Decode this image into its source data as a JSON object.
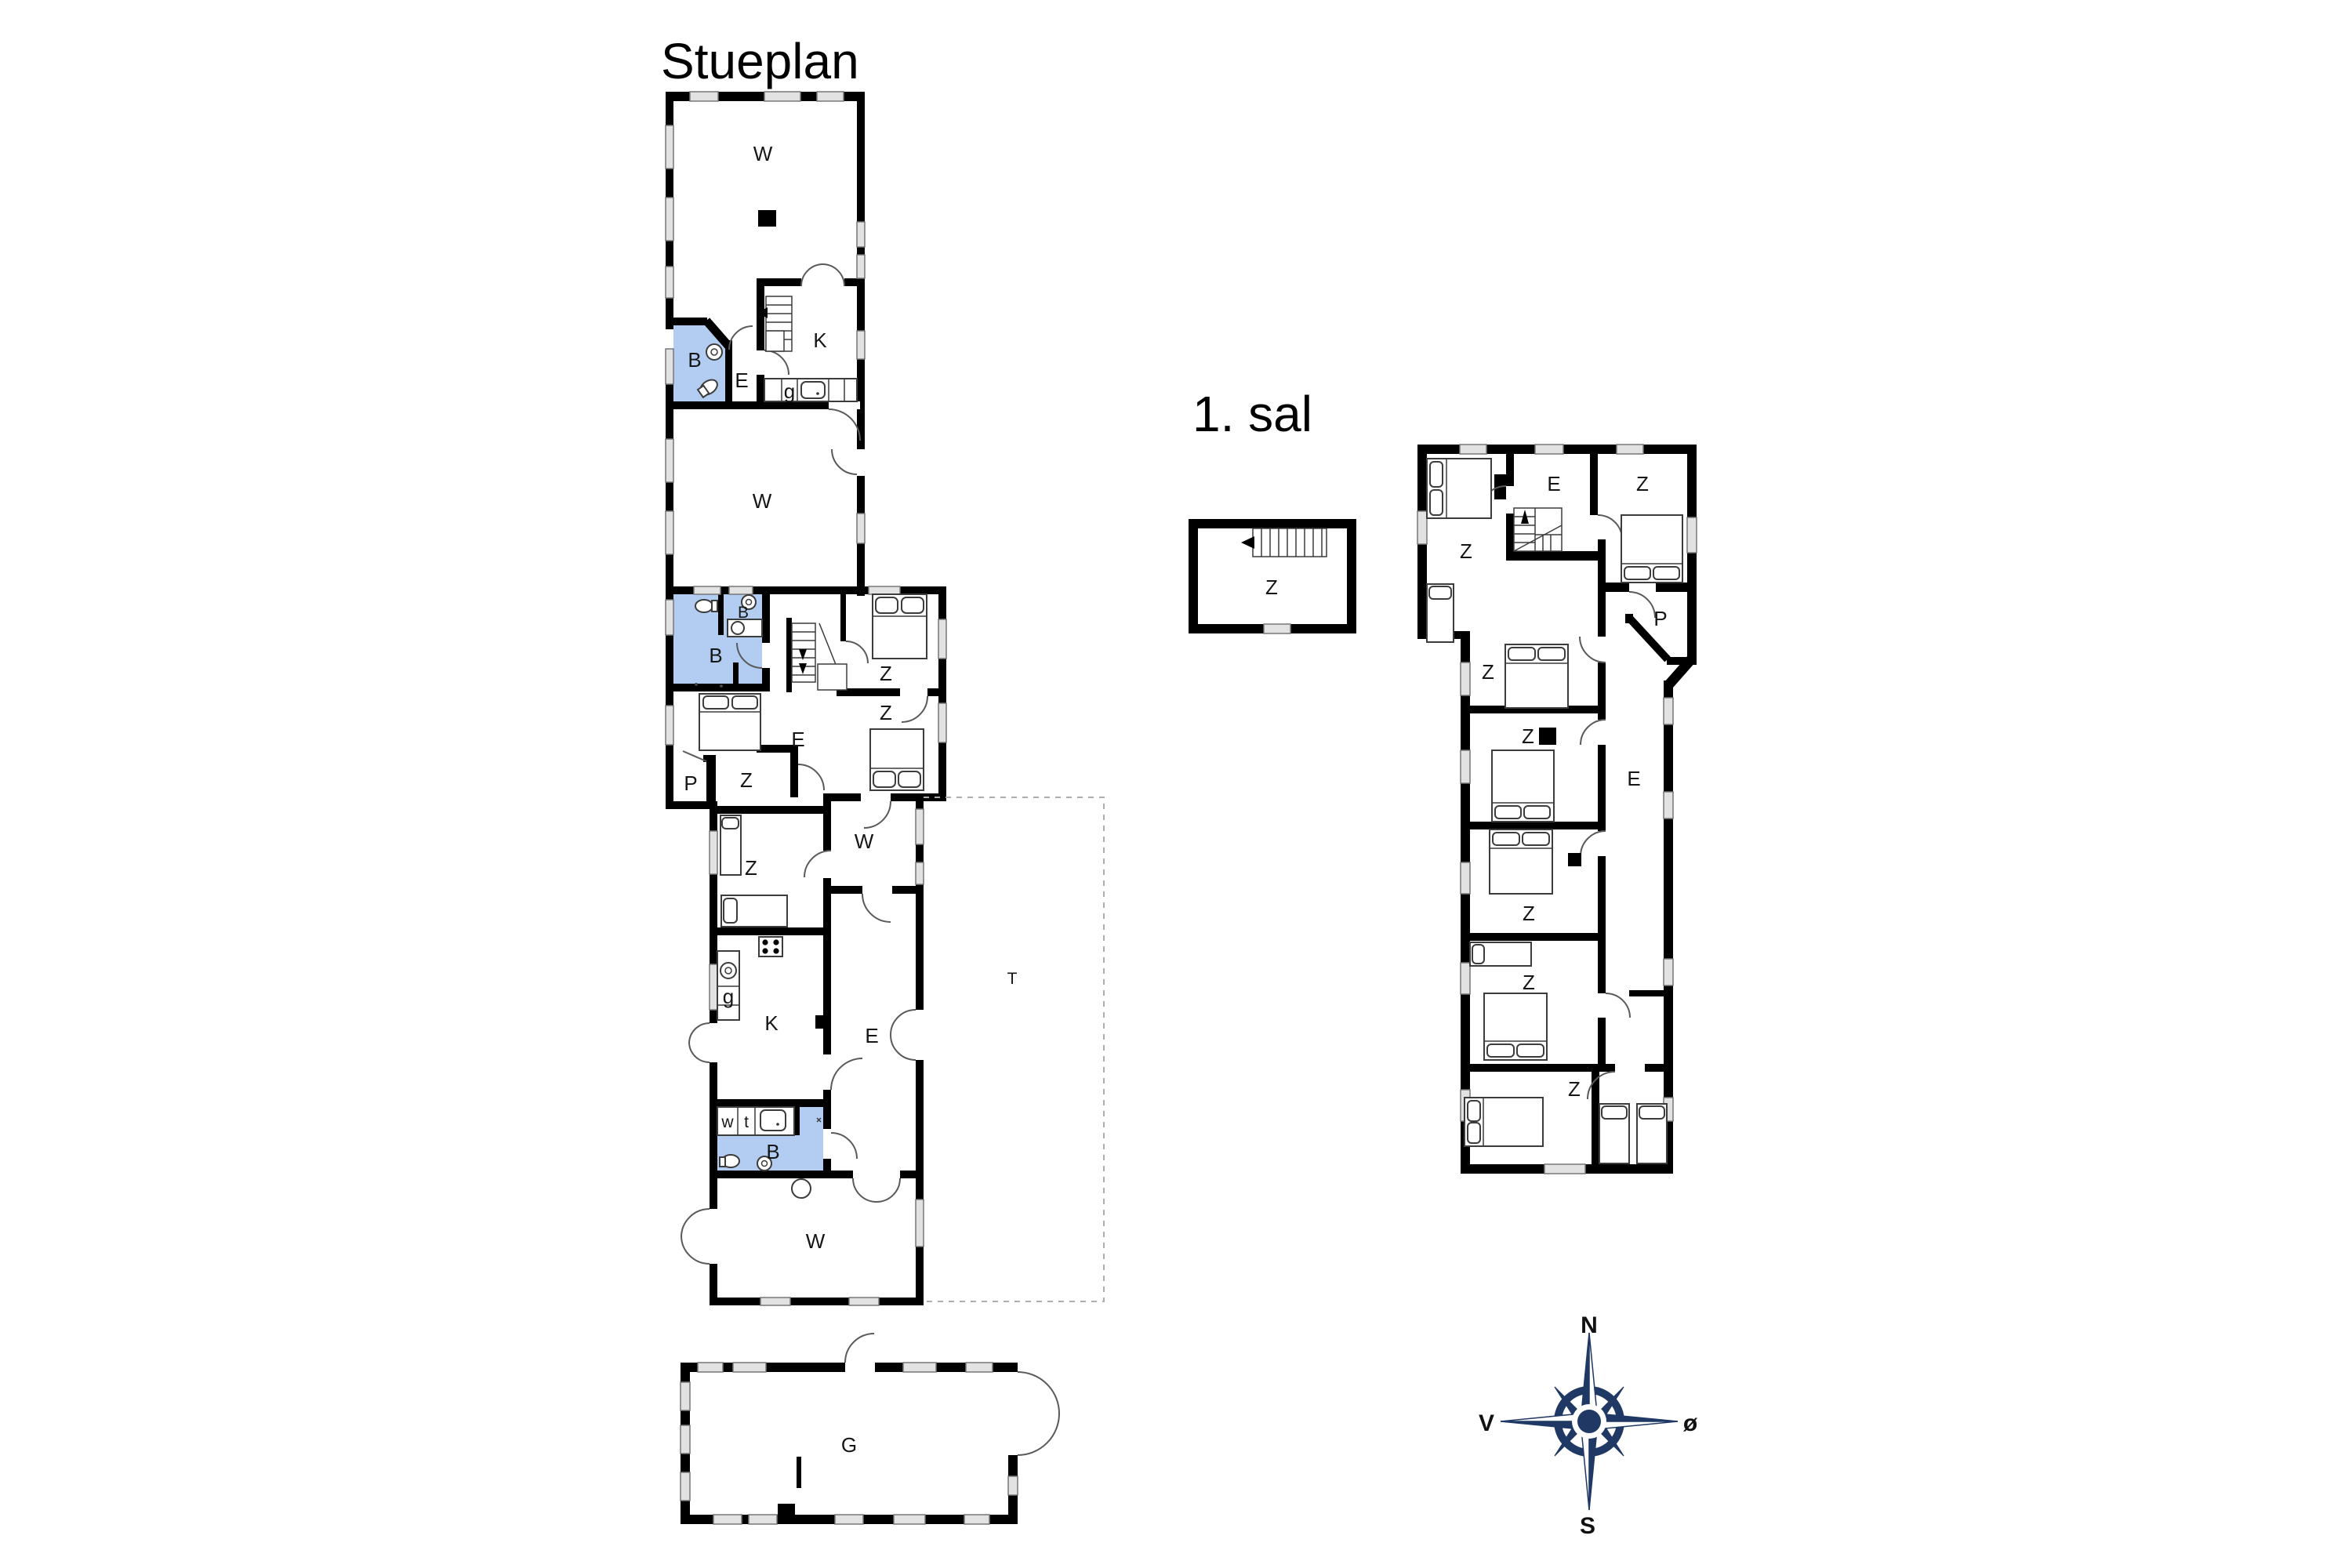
{
  "ground": {
    "title": "Stueplan",
    "labels": {
      "living1": "W",
      "kitchen1": "K",
      "bath1": "B",
      "entry1": "E",
      "pantry1": "g",
      "living2": "W",
      "bath2_small": "B",
      "bath2": "B",
      "bed_ne": "Z",
      "bed_e": "Z",
      "hall_mid": "E",
      "closet": "P",
      "bed_mid": "Z",
      "bed_low": "Z",
      "hall_low": "W",
      "pantry2": "g",
      "kitchen2": "K",
      "hall_big": "E",
      "utility_w": "w",
      "utility_t": "t",
      "bath3": "B",
      "living3": "W",
      "terrace": "T"
    },
    "garage_label": "G"
  },
  "first": {
    "title": "1. sal",
    "annex_room": "Z",
    "labels": {
      "bed_nw": "Z",
      "hall_top": "E",
      "bed_ne": "Z",
      "closet": "P",
      "bed2": "Z",
      "bed3": "Z",
      "hall_right": "E",
      "bed4": "Z",
      "bed5": "Z",
      "bed6": "Z"
    }
  },
  "compass": {
    "north": "N",
    "south": "S",
    "east": "ø",
    "west": "V"
  },
  "colors": {
    "wall": "#000000",
    "bathroom_fill": "#b3cdf2",
    "compass_navy": "#1f3864"
  }
}
